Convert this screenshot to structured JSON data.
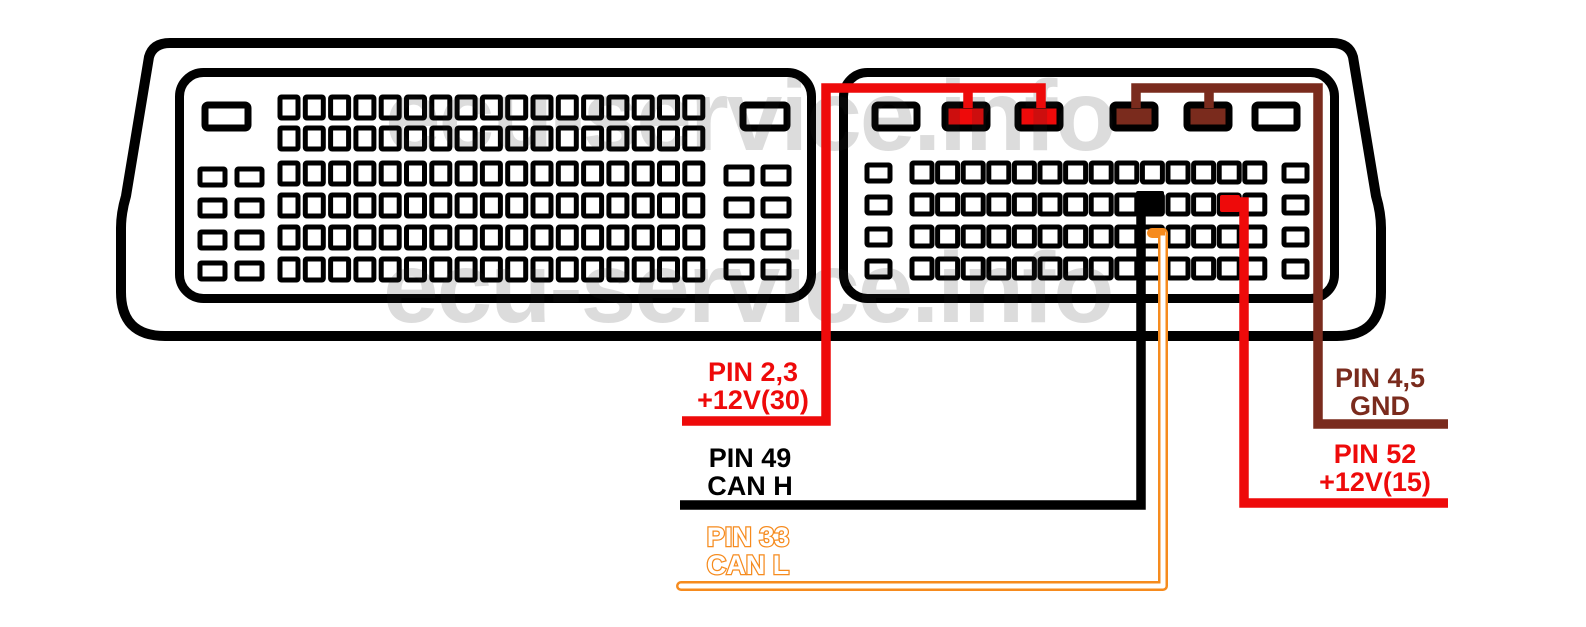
{
  "watermark": {
    "text": "ecu-service.info",
    "color": "rgba(40,40,40,0.16)",
    "instances": [
      {
        "x": 385,
        "y": 150,
        "size": 100
      },
      {
        "x": 383,
        "y": 322,
        "size": 100
      }
    ]
  },
  "labels": {
    "supply30": {
      "line1": "PIN 2,3",
      "line2": "+12V(30)",
      "color": "#ee0a0a",
      "outlined": false
    },
    "canh": {
      "line1": "PIN 49",
      "line2": "CAN H",
      "color": "#000000",
      "outlined": false
    },
    "canl": {
      "line1": "PIN 33",
      "line2": "CAN L",
      "color": "#f68b1e",
      "outlined": true
    },
    "gnd": {
      "line1": "PIN 4,5",
      "line2": "GND",
      "color": "#7a2b1d",
      "outlined": false
    },
    "supply15": {
      "line1": "PIN 52",
      "line2": "+12V(15)",
      "color": "#ee0a0a",
      "outlined": false
    }
  },
  "diagram": {
    "width": 1586,
    "height": 627,
    "colors": {
      "red": "#ee0a0a",
      "brown": "#7a2b1d",
      "orange": "#f68b1e",
      "black": "#000000",
      "white": "#ffffff"
    },
    "housing_path": "M 170 43 H 1332 Q 1349 43 1353 57 L 1376 196 Q 1381 213 1381 228 V 292 Q 1381 336 1337 336 H 165 Q 121 336 121 292 V 228 Q 121 213 126 196 L 149 57 Q 153 43 170 43 Z",
    "housing_stroke": 10,
    "blocks": [
      {
        "x": 179.5,
        "y": 72.5,
        "w": 632,
        "h": 226,
        "rx": 24,
        "stroke": 9
      },
      {
        "x": 843.5,
        "y": 72.5,
        "w": 491,
        "h": 226,
        "rx": 24,
        "stroke": 9
      }
    ],
    "big_pin_row": {
      "y": 105,
      "h": 23,
      "stroke": 7,
      "pins": [
        {
          "x": 205,
          "w": 43,
          "fill": "white"
        },
        {
          "x": 743,
          "w": 44,
          "fill": "white"
        },
        {
          "x": 875,
          "w": 42,
          "fill": "white"
        },
        {
          "x": 945,
          "w": 42,
          "fill": "red"
        },
        {
          "x": 1018,
          "w": 42,
          "fill": "red"
        },
        {
          "x": 1113,
          "w": 42,
          "fill": "brown"
        },
        {
          "x": 1187,
          "w": 42,
          "fill": "brown"
        },
        {
          "x": 1255,
          "w": 42,
          "fill": "white"
        }
      ]
    },
    "pin_grids": [
      {
        "x": 280,
        "pitch": 25.3,
        "cols": 17,
        "rows": [
          97,
          128,
          163,
          195,
          227,
          259
        ],
        "w": 18,
        "h": 21,
        "stroke": 5
      },
      {
        "x": 200,
        "pitch": 37,
        "cols": 2,
        "rows": [
          169,
          200,
          232,
          263
        ],
        "w": 25,
        "h": 16,
        "stroke": 5
      },
      {
        "x": 726,
        "pitch": 37,
        "cols": 2,
        "rows": [
          167,
          199,
          231,
          261
        ],
        "w": 26,
        "h": 17,
        "stroke": 5
      },
      {
        "x": 912,
        "pitch": 25.6,
        "cols": 14,
        "rows": [
          163,
          195,
          227,
          259
        ],
        "w": 20,
        "h": 19,
        "stroke": 5
      },
      {
        "x": 867,
        "pitch": 40,
        "cols": 1,
        "rows": [
          165,
          197,
          229,
          261
        ],
        "w": 23,
        "h": 16,
        "stroke": 5
      },
      {
        "x": 1284,
        "pitch": 40,
        "cols": 1,
        "rows": [
          165,
          197,
          229,
          261
        ],
        "w": 23,
        "h": 16,
        "stroke": 5
      }
    ],
    "filled_pins": [
      {
        "name": "pin-49-can-h",
        "x": 1136,
        "y": 191,
        "w": 28,
        "h": 24,
        "color": "black"
      },
      {
        "name": "pin-52-12v15",
        "x": 1220,
        "y": 195,
        "w": 20,
        "h": 17,
        "color": "red"
      }
    ],
    "wires": [
      {
        "name": "supply30-wire",
        "color": "red",
        "width": 9.5,
        "path": "M 682 421 H 826 V 88 H 1041 V 108 M 968 88 V 108"
      },
      {
        "name": "gnd-wire",
        "color": "brown",
        "width": 9.5,
        "path": "M 1448 424 H 1318 V 88 H 1136 V 108 M 1209 88 V 108"
      },
      {
        "name": "canh-wire",
        "color": "black",
        "width": 9.5,
        "path": "M 680 505 H 1141 V 202"
      },
      {
        "name": "supply15-wire",
        "color": "red",
        "width": 9.5,
        "path": "M 1232 202 H 1244 V 503 H 1448"
      },
      {
        "name": "canl-wire",
        "color": "orange",
        "width": 10,
        "path": "M 1152 233 H 1163 V 586 H 681",
        "core": "white",
        "core_width": 5,
        "rounded": true
      },
      {
        "name": "canl-stub",
        "color": "orange",
        "width": 5,
        "path": "M 1149 233 H 1165"
      }
    ]
  }
}
